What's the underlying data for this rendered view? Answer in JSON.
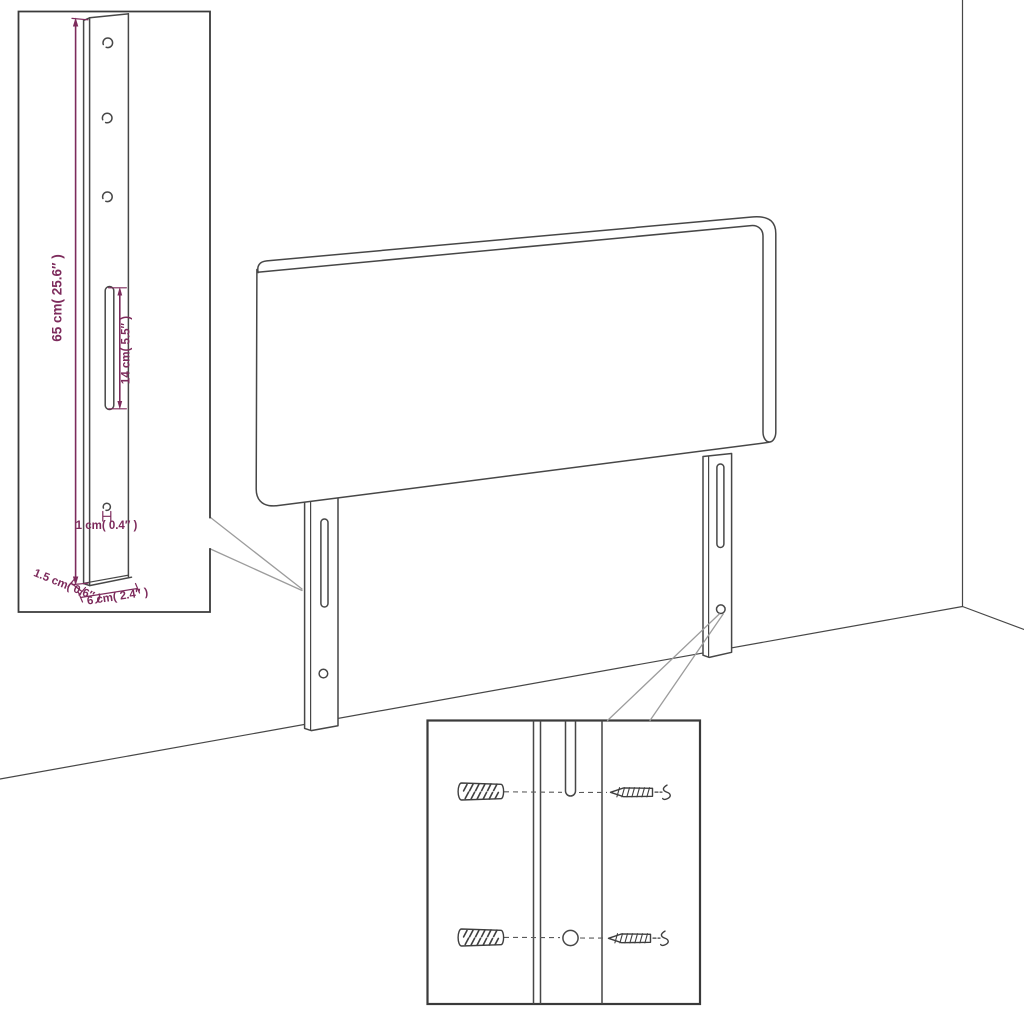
{
  "colors": {
    "line": "#474747",
    "box_border": "#3a3a3a",
    "callout": "#9c9c9c",
    "accent": "#7d2b5c",
    "background": "#ffffff"
  },
  "detail_leg": {
    "dim_height": "65 cm( 25.6″ )",
    "dim_slot": "14 cm( 5.5″ )",
    "dim_hole": "1 cm( 0.4″ )",
    "dim_thickness": "1.5 cm( 0.6″ )",
    "dim_width": "6 cm( 2.4″ )"
  }
}
